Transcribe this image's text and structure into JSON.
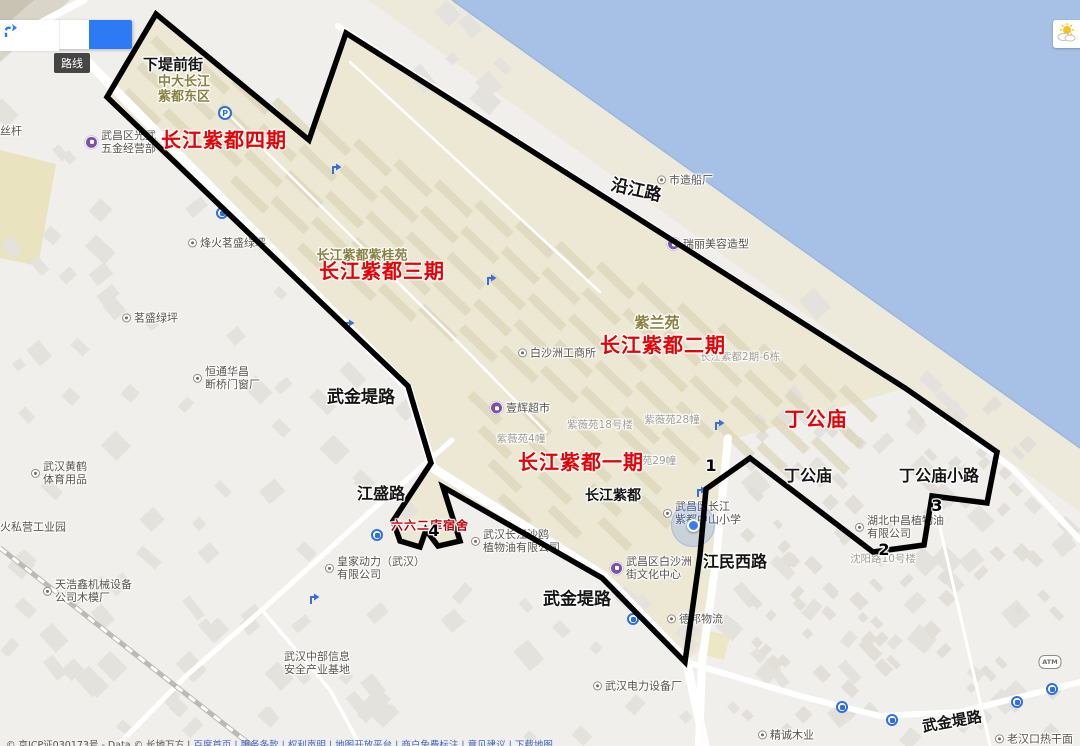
{
  "search": {
    "directions_tooltip": "路线"
  },
  "attribution": {
    "text": "© 京ICP证030173号 - Data © 长地万方 |",
    "links": "百度首页 | 服务条款 | 权利声明 | 地图开放平台 | 商户免费标注 | 意见建议 | 下载地图"
  },
  "map": {
    "colors": {
      "water": "#a6c1e5",
      "land": "#f1efec",
      "residential": "#ece8d4",
      "red_label": "#e60004"
    },
    "red_labels": [
      {
        "text": "长江紫都四期",
        "x": 224,
        "y": 140,
        "size": 20
      },
      {
        "text": "长江紫都三期",
        "x": 382,
        "y": 271,
        "size": 20
      },
      {
        "text": "长江紫都二期",
        "x": 663,
        "y": 345,
        "size": 20
      },
      {
        "text": "长江紫都一期",
        "x": 581,
        "y": 462,
        "size": 20
      },
      {
        "text": "丁公庙",
        "x": 816,
        "y": 419,
        "size": 20
      },
      {
        "text": "六六二库宿舍",
        "x": 430,
        "y": 526,
        "size": 12,
        "color": "#c00006"
      }
    ],
    "road_labels": [
      {
        "text": "下堤前街",
        "x": 173,
        "y": 65,
        "size": 15
      },
      {
        "text": "沿江路",
        "x": 636,
        "y": 191,
        "size": 17,
        "rotate": 13
      },
      {
        "text": "武金堤路",
        "x": 361,
        "y": 398,
        "size": 17
      },
      {
        "text": "江盛路",
        "x": 381,
        "y": 494,
        "size": 16
      },
      {
        "text": "武金堤路",
        "x": 577,
        "y": 600,
        "size": 17
      },
      {
        "text": "江民西路",
        "x": 735,
        "y": 562,
        "size": 16
      },
      {
        "text": "丁公庙",
        "x": 808,
        "y": 476,
        "size": 16
      },
      {
        "text": "丁公庙小路",
        "x": 939,
        "y": 476,
        "size": 16
      },
      {
        "text": "武金堤路",
        "x": 952,
        "y": 722,
        "size": 15,
        "rotate": -10
      },
      {
        "text": "长江紫都",
        "x": 613,
        "y": 497,
        "size": 14
      }
    ],
    "area_labels": [
      {
        "text": "中大长江\n紫都东区",
        "x": 184,
        "y": 90,
        "size": 13
      },
      {
        "text": "长江紫都紫桂苑",
        "x": 362,
        "y": 257,
        "size": 13
      },
      {
        "text": "紫兰苑",
        "x": 657,
        "y": 323,
        "size": 15
      }
    ],
    "building_labels": [
      {
        "text": "长江紫都2期-6栋",
        "x": 740,
        "y": 358
      },
      {
        "text": "紫薇苑18号楼",
        "x": 600,
        "y": 426
      },
      {
        "text": "紫薇苑28幢",
        "x": 672,
        "y": 421
      },
      {
        "text": "紫薇苑4幢",
        "x": 521,
        "y": 440
      },
      {
        "text": "苑29幢",
        "x": 659,
        "y": 462
      },
      {
        "text": "沈阳路10号楼",
        "x": 883,
        "y": 560
      }
    ],
    "numbers": [
      {
        "text": "1",
        "x": 711,
        "y": 466
      },
      {
        "text": "2",
        "x": 884,
        "y": 550
      },
      {
        "text": "3",
        "x": 937,
        "y": 506
      },
      {
        "text": "4",
        "x": 434,
        "y": 531
      }
    ],
    "pois": [
      {
        "icon": "purple",
        "x": 85,
        "y": 142,
        "text": "武昌区光武\n五金经营部"
      },
      {
        "icon": "dot",
        "x": 188,
        "y": 243,
        "text": "烽火茗盛绿坪"
      },
      {
        "icon": "dot",
        "x": 122,
        "y": 318,
        "text": "茗盛绿坪"
      },
      {
        "icon": "dot",
        "x": 193,
        "y": 378,
        "text": "恒通华昌\n断桥门窗厂"
      },
      {
        "icon": "dot",
        "x": 31,
        "y": 473,
        "text": "武汉黄鹤\n体育用品"
      },
      {
        "icon": "dot",
        "x": 43,
        "y": 591,
        "text": "天浩鑫机械设备\n公司木模厂"
      },
      {
        "icon": "dot",
        "x": 325,
        "y": 568,
        "text": "皇家动力（武汉）\n有限公司"
      },
      {
        "icon": "dot",
        "x": 471,
        "y": 541,
        "text": "武汉长江沙鸥\n植物油有限公司"
      },
      {
        "icon": "dot",
        "x": 518,
        "y": 353,
        "text": "白沙洲工商所"
      },
      {
        "icon": "purple",
        "x": 490,
        "y": 408,
        "text": "壹辉超市"
      },
      {
        "icon": "dot",
        "x": 663,
        "y": 513,
        "text": "武昌区长江\n紫都中山小学"
      },
      {
        "icon": "purple",
        "x": 610,
        "y": 568,
        "text": "武昌区白沙洲\n街文化中心"
      },
      {
        "icon": "dot",
        "x": 657,
        "y": 180,
        "text": "市造船厂"
      },
      {
        "icon": "purple",
        "x": 667,
        "y": 244,
        "text": "瑞丽美容造型"
      },
      {
        "icon": "dot",
        "x": 855,
        "y": 527,
        "text": "湖北中昌植物油\n有限公司"
      },
      {
        "icon": "dot",
        "x": 667,
        "y": 619,
        "text": "德邦物流"
      },
      {
        "icon": "dot",
        "x": 593,
        "y": 686,
        "text": "武汉电力设备厂"
      },
      {
        "icon": "dot",
        "x": 758,
        "y": 735,
        "text": "精诚木业"
      },
      {
        "icon": "dot",
        "x": 995,
        "y": 739,
        "text": "老汉口热干面"
      },
      {
        "icon": "none",
        "x": 317,
        "y": 663,
        "text": "武汉中部信息\n安全产业基地"
      },
      {
        "icon": "none",
        "x": 0,
        "y": 527,
        "text": "火私营工业园",
        "anchor": "left"
      },
      {
        "icon": "none",
        "x": 0,
        "y": 131,
        "text": "丝杆",
        "anchor": "left"
      }
    ],
    "icons": [
      {
        "type": "p",
        "x": 225,
        "y": 113
      },
      {
        "type": "bus",
        "x": 222,
        "y": 213
      },
      {
        "type": "bus",
        "x": 377,
        "y": 535
      },
      {
        "type": "bus",
        "x": 633,
        "y": 619
      },
      {
        "type": "bus",
        "x": 842,
        "y": 707
      },
      {
        "type": "bus",
        "x": 892,
        "y": 720
      },
      {
        "type": "bus",
        "x": 1017,
        "y": 702
      },
      {
        "type": "bus",
        "x": 1052,
        "y": 689
      },
      {
        "type": "atm",
        "x": 1050,
        "y": 662
      },
      {
        "type": "turn",
        "x": 330,
        "y": 162
      },
      {
        "type": "turn",
        "x": 485,
        "y": 273
      },
      {
        "type": "turn",
        "x": 343,
        "y": 318
      },
      {
        "type": "turn",
        "x": 713,
        "y": 418
      },
      {
        "type": "turn",
        "x": 695,
        "y": 485
      },
      {
        "type": "turn",
        "x": 308,
        "y": 592
      },
      {
        "type": "loc",
        "x": 693,
        "y": 525
      }
    ],
    "annotation": {
      "polygon_points": "107,97 156,14 309,140 346,33 905,388 997,452 987,503 932,496 924,545 873,552 750,458 706,489 700,555 685,662 602,578 443,487 460,541 438,546 426,530 420,547 400,541 393,521 431,463 408,386",
      "stroke": "#000000",
      "stroke_width": 5.5
    }
  }
}
